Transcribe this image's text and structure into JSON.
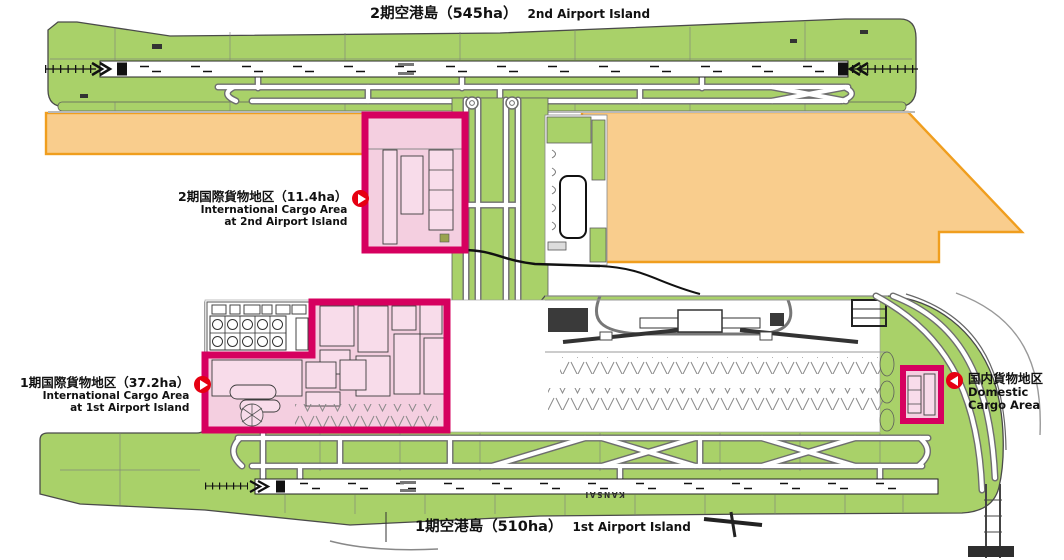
{
  "islands": {
    "second": {
      "title_ja": "2期空港島（545ha）",
      "title_en": "2nd Airport Island"
    },
    "first": {
      "title_ja": "1期空港島（510ha）",
      "title_en": "1st Airport Island"
    }
  },
  "areas": {
    "intl_cargo_2nd": {
      "label_ja": "2期国際貨物地区（11.4ha）",
      "label_en_line1": "International Cargo Area",
      "label_en_line2": "at 2nd Airport Island",
      "size_ha": 11.4
    },
    "intl_cargo_1st": {
      "label_ja": "1期国際貨物地区（37.2ha）",
      "label_en_line1": "International Cargo Area",
      "label_en_line2": "at 1st Airport Island",
      "size_ha": 37.2
    },
    "domestic_cargo": {
      "label_ja": "国内貨物地区",
      "label_en": "Domestic Cargo Area"
    }
  },
  "map_text": {
    "runway_name": "KANSAI"
  },
  "colors": {
    "island_green": "#a9d169",
    "future_area_fill": "#f9cd8d",
    "future_area_border": "#f09e1e",
    "highlight_fill": "#f4cfe0",
    "highlight_border": "#d6005f",
    "arrow_red": "#e60012"
  }
}
